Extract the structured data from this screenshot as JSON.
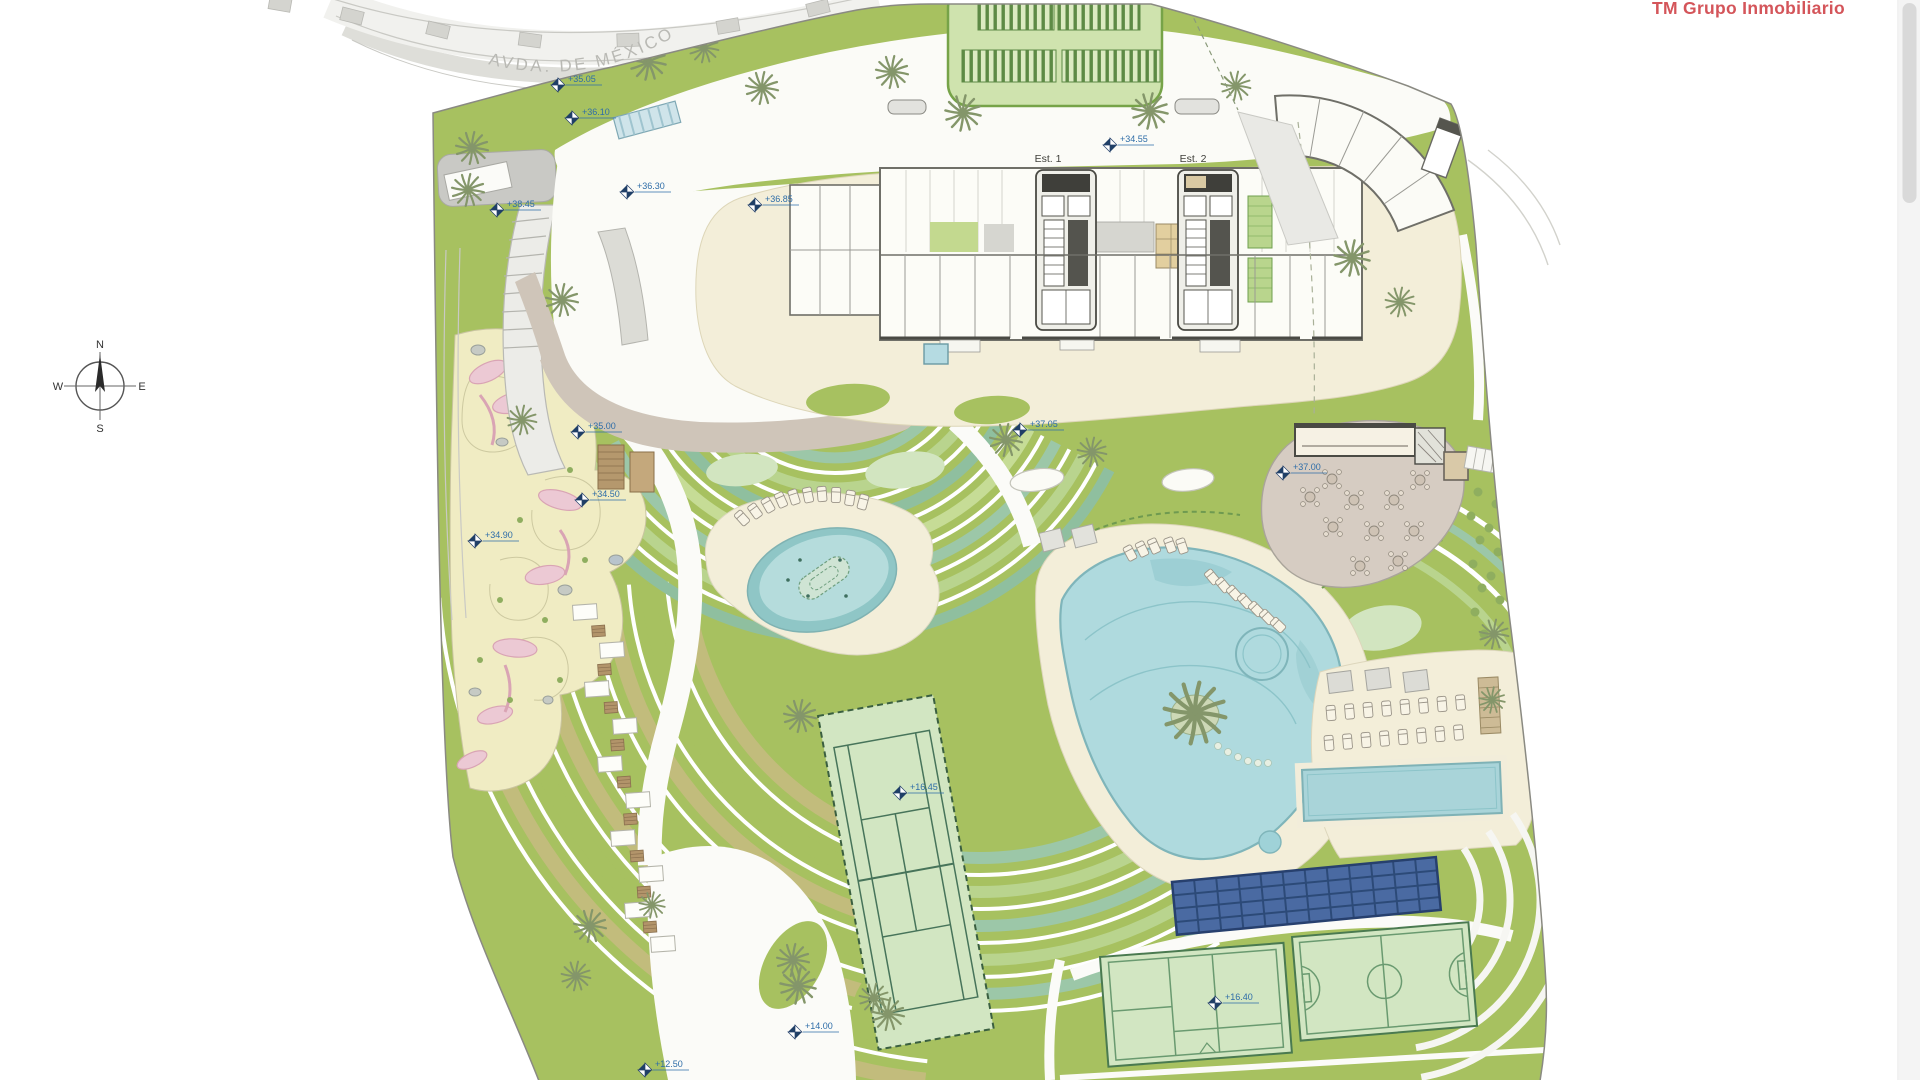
{
  "header": {
    "company": "TM Grupo Inmobiliario"
  },
  "plan": {
    "street": "AVDA. DE MÉXICO",
    "compass": {
      "north": "N",
      "south": "S",
      "east": "E",
      "west": "W"
    },
    "building": {
      "stair1": "Est. 1",
      "stair2": "Est. 2"
    },
    "elevation_markers": [
      {
        "x": 558,
        "y": 85,
        "label": "+35.05"
      },
      {
        "x": 572,
        "y": 118,
        "label": "+36.10"
      },
      {
        "x": 497,
        "y": 210,
        "label": "+38.45"
      },
      {
        "x": 627,
        "y": 192,
        "label": "+36.30"
      },
      {
        "x": 755,
        "y": 205,
        "label": "+36.85"
      },
      {
        "x": 1110,
        "y": 145,
        "label": "+34.55"
      },
      {
        "x": 1020,
        "y": 430,
        "label": "+37.05"
      },
      {
        "x": 578,
        "y": 432,
        "label": "+35.00"
      },
      {
        "x": 582,
        "y": 500,
        "label": "+34.50"
      },
      {
        "x": 475,
        "y": 541,
        "label": "+34.90"
      },
      {
        "x": 1283,
        "y": 473,
        "label": "+37.00"
      },
      {
        "x": 900,
        "y": 793,
        "label": "+16.45"
      },
      {
        "x": 1215,
        "y": 1003,
        "label": "+16.40"
      },
      {
        "x": 795,
        "y": 1032,
        "label": "+14.00"
      },
      {
        "x": 645,
        "y": 1070,
        "label": "+12.50"
      }
    ]
  },
  "palette": {
    "background": "#ffffff",
    "site_green": "#a7c160",
    "light_green": "#c6dc96",
    "mint": "#d2e5c0",
    "hedge_teal": "#9cc7a8",
    "pale_court": "#d2e6c2",
    "court_line": "#47745a",
    "cream": "#f3eed9",
    "play": "#f0ecc3",
    "pink": "#ecc9d4",
    "tan": "#cfc5b9",
    "khaki": "#c2bc7c",
    "brown": "#b2946a",
    "water": "#afdade",
    "water_deep": "#8cc4c9",
    "road": "#f1f1ee",
    "sidewalk": "#deded9",
    "platform_gray": "#c9c9c5",
    "solar": "#49699f",
    "solar_dark": "#27406e",
    "wall": "#6f6f68",
    "logo_red": "#d4555a",
    "marker_blue": "#2e6da8",
    "marker_navy": "#1f3f66",
    "label_gray": "#b9b9b4"
  }
}
